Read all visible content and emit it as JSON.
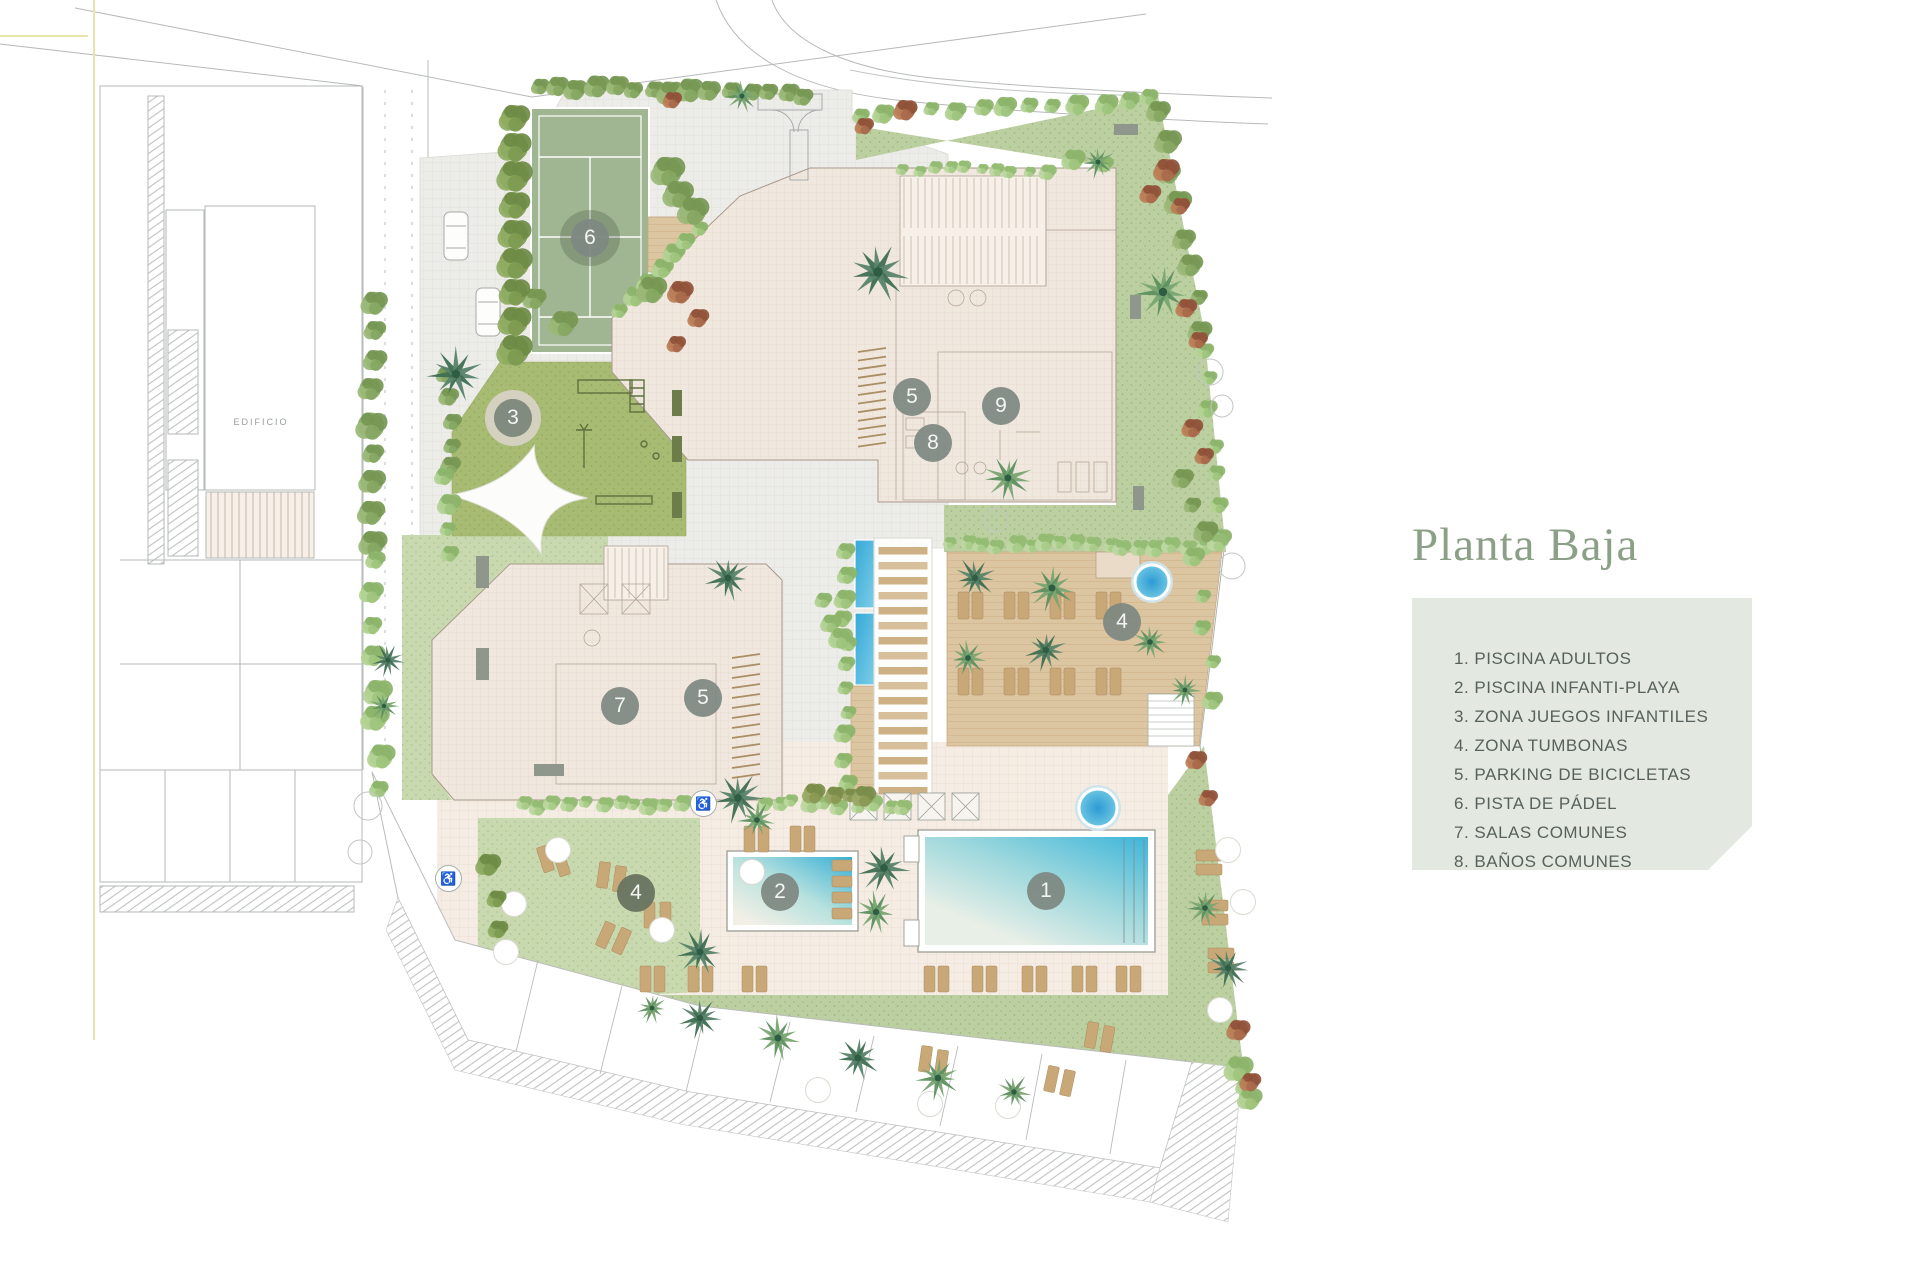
{
  "plan": {
    "context_label": "EDIFICIO",
    "markers": [
      {
        "number": "1",
        "name": "piscina-adultos",
        "x": 1046,
        "y": 891,
        "variant": "default"
      },
      {
        "number": "2",
        "name": "piscina-infanti-playa",
        "x": 780,
        "y": 892,
        "variant": "default"
      },
      {
        "number": "3",
        "name": "zona-juegos-infantiles",
        "x": 513,
        "y": 418,
        "variant": "ring"
      },
      {
        "number": "4",
        "name": "zona-tumbonas-deck",
        "x": 1122,
        "y": 622,
        "variant": "default"
      },
      {
        "number": "4",
        "name": "zona-tumbonas-lawn",
        "x": 636,
        "y": 893,
        "variant": "dark"
      },
      {
        "number": "5",
        "name": "parking-bicicletas-norte",
        "x": 912,
        "y": 397,
        "variant": "default"
      },
      {
        "number": "5",
        "name": "parking-bicicletas-oeste",
        "x": 703,
        "y": 698,
        "variant": "default"
      },
      {
        "number": "6",
        "name": "pista-padel",
        "x": 590,
        "y": 238,
        "variant": "default"
      },
      {
        "number": "7",
        "name": "salas-comunes",
        "x": 620,
        "y": 706,
        "variant": "default"
      },
      {
        "number": "8",
        "name": "banos-comunes",
        "x": 933,
        "y": 443,
        "variant": "default"
      },
      {
        "number": "9",
        "name": "gimnasio",
        "x": 1001,
        "y": 406,
        "variant": "default"
      }
    ],
    "badges": [
      {
        "glyph": "♿",
        "x": 703,
        "y": 803
      },
      {
        "glyph": "♿",
        "x": 448,
        "y": 878
      }
    ]
  },
  "legend": {
    "title": "Planta Baja",
    "items": [
      {
        "num": "1.",
        "label": "PISCINA ADULTOS"
      },
      {
        "num": "2.",
        "label": "PISCINA INFANTI-PLAYA"
      },
      {
        "num": "3.",
        "label": "ZONA JUEGOS INFANTILES"
      },
      {
        "num": "4.",
        "label": "ZONA TUMBONAS"
      },
      {
        "num": "5.",
        "label": "PARKING DE BICICLETAS"
      },
      {
        "num": "6.",
        "label": "PISTA DE PÁDEL"
      },
      {
        "num": "7.",
        "label": "SALAS COMUNES"
      },
      {
        "num": "8.",
        "label": "BAÑOS COMUNES"
      },
      {
        "num": "9.",
        "label": "GIMNASIO"
      }
    ]
  },
  "palette": {
    "accent_green": "#8ba087",
    "legend_bg": "#e3e8e0",
    "legend_text": "#57625c",
    "lawn": "#bccfa1",
    "playground": "#a8bb73",
    "padel": "#a0b591",
    "deck_wood": "#dcc5a1",
    "building": "#f0e7de",
    "water": "#3eb6da",
    "marker": "#7e8881"
  }
}
